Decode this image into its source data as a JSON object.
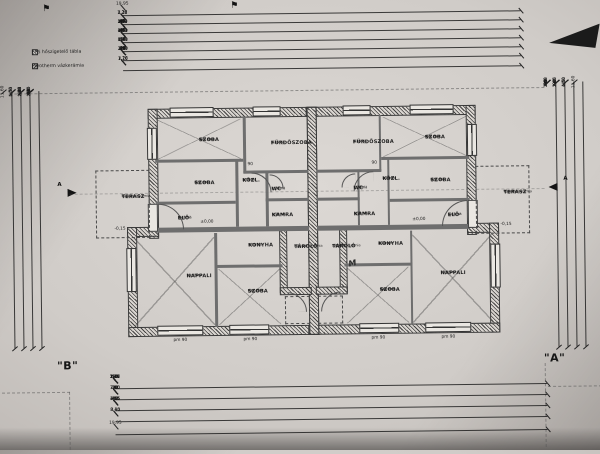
{
  "sheet": {
    "width_total": "19,95",
    "height_total": "11,60",
    "left_unit_mark": "\"B\"",
    "right_unit_mark": "\"A\""
  },
  "legend": {
    "items": [
      "EPS hőszigetelő tábla",
      "Porotherm vázkerámia"
    ]
  },
  "rooms": [
    {
      "name": "SZOBA",
      "material": "lam. park.",
      "area": "9,41 m²"
    },
    {
      "name": "FÜRDŐSZOBA",
      "material": "kerámia",
      "area": "3,76 m²"
    },
    {
      "name": "SZOBA",
      "material": "lam. park.",
      "area": "8,01 m²"
    },
    {
      "name": "KÖZL.",
      "material": "kerámia",
      "area": "3,18 m²"
    },
    {
      "name": "WC",
      "material": "kerámia",
      "area": "1,10 m²"
    },
    {
      "name": "KAMRA",
      "material": "kerámia",
      "area": "1,52 m²"
    },
    {
      "name": "ELŐ",
      "material": "kerámia",
      "area": "3,43 m²"
    },
    {
      "name": "KONYHA",
      "material": "kerámia",
      "area": "8,10 m²"
    },
    {
      "name": "NAPPALI",
      "material": "kerámia",
      "area": "23,53 m²"
    },
    {
      "name": "SZOBA",
      "material": "lam. park.",
      "area": "9,60 m²"
    },
    {
      "name": "TÁROLÓ",
      "material": "fagyálló kerámia",
      "area": "3,15 m²"
    },
    {
      "name": "TERASZ",
      "material": "fagyálló kerámia",
      "area": "4,70 m²"
    }
  ],
  "annotations": {
    "level_zero": "±0,00",
    "level_terrace": "-0,15",
    "window_sill": "pm 90",
    "door_width": "90",
    "section_letter": "A",
    "handwritten_mark": "M"
  },
  "dimensions": {
    "top_rows": [
      [
        "19,95"
      ],
      [
        "1,22",
        "7,26",
        "3,15",
        "7,26",
        "1,20"
      ],
      [
        "1,20",
        "40",
        "3,52",
        "10",
        "90",
        "10",
        "1,80",
        "40",
        "1,52",
        "15",
        "1,51",
        "40",
        "1,80",
        "10",
        "90",
        "10",
        "3,52",
        "40",
        "1,20"
      ],
      [
        "1,20",
        "40",
        "4,51",
        "10",
        "90",
        "1,80",
        "40",
        "1,11",
        "1,11",
        "40",
        "1,80",
        "90",
        "10",
        "4,51",
        "40",
        "1,20"
      ],
      [
        "1,20",
        "10",
        "30",
        "8,41",
        "90",
        "1,31",
        "90",
        "8,41",
        "30",
        "10",
        "1,20"
      ],
      [
        "45",
        "30",
        "90",
        "20",
        "3,90",
        "20",
        "2,90",
        "30",
        "1,31",
        "30",
        "2,90",
        "20",
        "3,90",
        "20",
        "90",
        "30",
        "45"
      ],
      [
        "1,78",
        "7,26",
        "3,15",
        "7,26",
        "1,78"
      ]
    ],
    "bottom_rows": [
      [
        "10",
        "1,76",
        "2,26",
        "2,42",
        "1,77",
        "90",
        "1,75",
        "90",
        "1,75",
        "90",
        "1,77",
        "2,42",
        "2,26",
        "1,76",
        "10"
      ],
      [
        "10",
        "30",
        "7,00",
        "30",
        "3,35",
        "30",
        "7,00",
        "30",
        "10"
      ],
      [
        "40",
        "4,51",
        "10",
        "2,85",
        "40",
        "3,15",
        "40",
        "2,85",
        "10",
        "4,51",
        "40"
      ],
      [
        "8,40",
        "3,15",
        "8,40"
      ],
      [
        "19,95"
      ]
    ],
    "left_cols": [
      [
        "11,60"
      ],
      [
        "45",
        "5,30",
        "4,50",
        "1,35"
      ],
      [
        "1,35",
        "2,18",
        "90",
        "2,22",
        "90",
        "2,40",
        "1,65"
      ],
      [
        "40",
        "2,70",
        "10",
        "25",
        "1,40",
        "90",
        "25",
        "2,40",
        "25",
        "90",
        "25",
        "1,35",
        "40"
      ]
    ],
    "right_cols": [
      [
        "40",
        "1,60",
        "25",
        "90",
        "25",
        "2,08",
        "25",
        "90",
        "25",
        "3,08",
        "40"
      ],
      [
        "1,75",
        "90",
        "2,05",
        "90",
        "2,85",
        "1,60"
      ],
      [
        "45",
        "4,50",
        "4,50",
        "1,21"
      ],
      [
        "11,60"
      ]
    ]
  }
}
